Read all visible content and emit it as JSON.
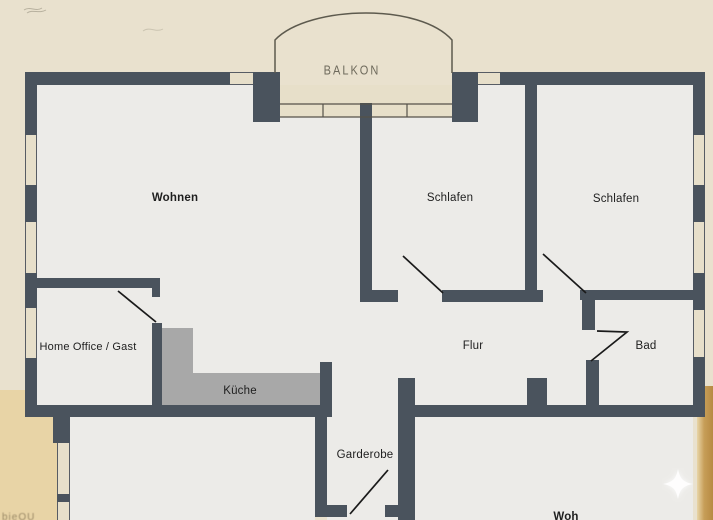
{
  "plan": {
    "type": "floor-plan",
    "rooms": [
      {
        "id": "balkon",
        "label": "BALKON"
      },
      {
        "id": "wohnen",
        "label": "Wohnen"
      },
      {
        "id": "schlafen-1",
        "label": "Schlafen"
      },
      {
        "id": "schlafen-2",
        "label": "Schlafen"
      },
      {
        "id": "home-office",
        "label": "Home Office / Gast"
      },
      {
        "id": "kueche",
        "label": "Küche"
      },
      {
        "id": "flur",
        "label": "Flur"
      },
      {
        "id": "bad",
        "label": "Bad"
      },
      {
        "id": "garderobe",
        "label": "Garderobe"
      },
      {
        "id": "woh-clipped",
        "label": "Woh"
      }
    ],
    "watermark_faint_text": "bieOU",
    "icons": [
      "sparkle-icon"
    ],
    "colors": {
      "wall": "#4a535d",
      "floor": "#ecebe8",
      "kitchen_floor": "#a8a8a8",
      "outside": "#e9e1ce",
      "outside_lower_left": "#e8d4a6",
      "gold_edge": "#c79e58",
      "window_fill": "#e7dfca",
      "door_line": "#1a1a1a",
      "balkon_line": "#5d5a4e",
      "label_text": "#1e1e1e"
    }
  }
}
